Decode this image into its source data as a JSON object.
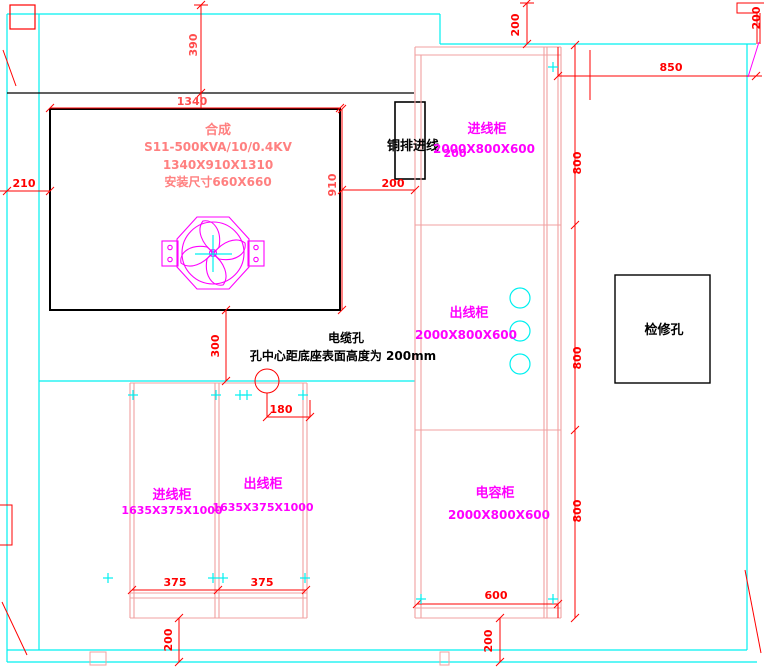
{
  "colors": {
    "wall_cyan": "#00f0f0",
    "dimension_red": "#ff0000",
    "transformer_text_pink": "#ff8080",
    "label_magenta": "#ff00ff",
    "cabinet_outline_salmon": "#f0a0a0",
    "drawing_black": "#000000"
  },
  "transformer": {
    "title": "合成",
    "model": "S11-500KVA/10/0.4KV",
    "size": "1340X910X1310",
    "mount": "安装尺寸660X660"
  },
  "busbar": {
    "label": "铜排进线",
    "dim_200": "200"
  },
  "cable_hole": {
    "label": "电缆孔",
    "note": "孔中心距底座表面高度为 200mm"
  },
  "inspection": {
    "label": "检修孔"
  },
  "right_cabinets": [
    {
      "name": "进线柜",
      "size": "2000X800X600"
    },
    {
      "name": "出线柜",
      "size": "2000X800X600"
    },
    {
      "name": "电容柜",
      "size": "2000X800X600"
    }
  ],
  "bottom_cabinets": [
    {
      "name": "进线柜",
      "size": "1635X375X1000"
    },
    {
      "name": "出线柜",
      "size": "1635X375X1000"
    }
  ],
  "dims": {
    "w1340": "1340",
    "h910": "910",
    "v390": "390",
    "h210": "210",
    "h200_gap": "200",
    "v300": "300",
    "h180": "180",
    "w375_left": "375",
    "w375_right": "375",
    "v200_bottom_left": "200",
    "w600": "600",
    "v200_bottom_right": "200",
    "h800_top": "800",
    "h800_mid": "800",
    "h800_bottom": "800",
    "w850": "850",
    "v200_top": "200",
    "v200_top_right": "200"
  }
}
